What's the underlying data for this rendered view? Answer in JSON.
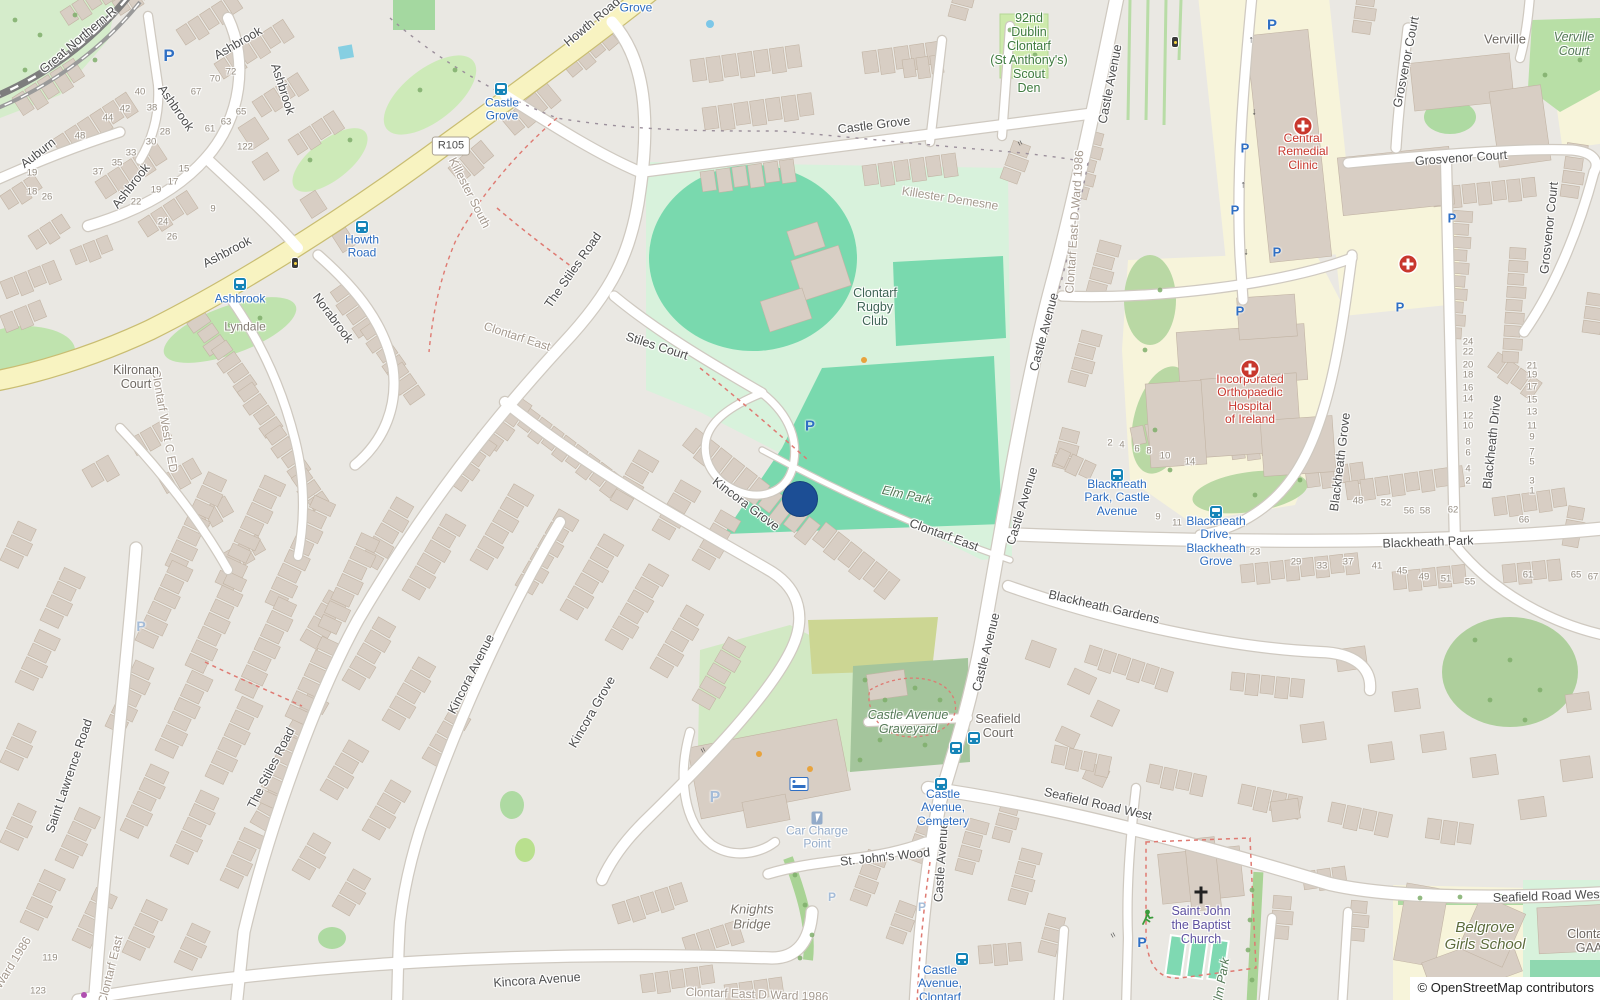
{
  "map": {
    "attribution": "© OpenStreetMap contributors",
    "route_badge": {
      "text": "R105",
      "x": 451,
      "y": 146
    },
    "marker": {
      "x": 800,
      "y": 499,
      "r": 17,
      "color": "#1c4e95"
    },
    "colors": {
      "bus_icon": "#1584b8",
      "parking": "#2f6fc4",
      "parking_faded": "#a5bcd8",
      "marker": "#1c4e95",
      "medical": "#c8372d",
      "church_label": "#5e50a0",
      "runner": "#3b9b3b",
      "bus_label": "#2b6bc0",
      "water": "#86cfe2"
    },
    "street_labels": [
      {
        "t": "Great Northern R",
        "x": 78,
        "y": 40,
        "r": -40
      },
      {
        "t": "Howth Road",
        "x": 592,
        "y": 22,
        "r": -40
      },
      {
        "t": "Ashbrook",
        "x": 238,
        "y": 43,
        "r": -30
      },
      {
        "t": "Ashbrook",
        "x": 283,
        "y": 89,
        "r": 72
      },
      {
        "t": "Ashbrook",
        "x": 176,
        "y": 108,
        "r": 55
      },
      {
        "t": "Ashbrook",
        "x": 131,
        "y": 186,
        "r": -52
      },
      {
        "t": "Ashbrook",
        "x": 227,
        "y": 252,
        "r": -28
      },
      {
        "t": "Auburn",
        "x": 38,
        "y": 153,
        "r": -38
      },
      {
        "t": "Norabrook",
        "x": 333,
        "y": 318,
        "r": 53
      },
      {
        "t": "Kincora Grove",
        "x": 746,
        "y": 504,
        "r": 37
      },
      {
        "t": "Kincora Grove",
        "x": 592,
        "y": 712,
        "r": -60
      },
      {
        "t": "Kincora Avenue",
        "x": 471,
        "y": 674,
        "r": -63
      },
      {
        "t": "Kincora Avenue",
        "x": 537,
        "y": 980,
        "r": -4
      },
      {
        "t": "The Stiles Road",
        "x": 573,
        "y": 270,
        "r": -55
      },
      {
        "t": "The Stiles Road",
        "x": 271,
        "y": 768,
        "r": -63
      },
      {
        "t": "Stiles Court",
        "x": 657,
        "y": 346,
        "r": 18
      },
      {
        "t": "Saint Lawrence Road",
        "x": 69,
        "y": 776,
        "r": -71
      },
      {
        "t": "Castle Grove",
        "x": 874,
        "y": 125,
        "r": -7
      },
      {
        "t": "Castle Avenue",
        "x": 1110,
        "y": 84,
        "r": -79
      },
      {
        "t": "Castle Avenue",
        "x": 1044,
        "y": 332,
        "r": -75
      },
      {
        "t": "Castle Avenue",
        "x": 1022,
        "y": 506,
        "r": -73
      },
      {
        "t": "Castle Avenue",
        "x": 986,
        "y": 652,
        "r": -76
      },
      {
        "t": "Castle Avenue",
        "x": 941,
        "y": 862,
        "r": -86
      },
      {
        "t": "Blackheath Park",
        "x": 1428,
        "y": 542,
        "r": -2
      },
      {
        "t": "Blackheath Gardens",
        "x": 1104,
        "y": 607,
        "r": 13
      },
      {
        "t": "Blackheath Grove",
        "x": 1340,
        "y": 462,
        "r": -83
      },
      {
        "t": "Blackheath Drive",
        "x": 1492,
        "y": 442,
        "r": -84
      },
      {
        "t": "Grosvenor Court",
        "x": 1406,
        "y": 62,
        "r": -79
      },
      {
        "t": "Grosvenor Court",
        "x": 1461,
        "y": 158,
        "r": -4
      },
      {
        "t": "Grosvenor Court",
        "x": 1549,
        "y": 228,
        "r": -84
      },
      {
        "t": "Seafield Road West",
        "x": 1098,
        "y": 804,
        "r": 13
      },
      {
        "t": "Seafield Road West",
        "x": 1548,
        "y": 896,
        "r": -2
      },
      {
        "t": "St. John's Wood",
        "x": 885,
        "y": 857,
        "r": -6
      },
      {
        "t": "Clontarf East",
        "x": 944,
        "y": 535,
        "r": 20
      }
    ],
    "boundary_labels": [
      {
        "t": "Killester South",
        "x": 469,
        "y": 193,
        "r": 63
      },
      {
        "t": "Clontarf West C ED",
        "x": 164,
        "y": 421,
        "r": 80
      },
      {
        "t": "Clontarf East",
        "x": 517,
        "y": 337,
        "r": 18
      },
      {
        "t": "Clontarf East",
        "x": 111,
        "y": 970,
        "r": -76
      },
      {
        "t": "Killester Demesne",
        "x": 950,
        "y": 199,
        "r": 9
      },
      {
        "t": "Clontarf East-D Ward 1986",
        "x": 1075,
        "y": 222,
        "r": -86
      },
      {
        "t": "Clontarf East D Ward 1986",
        "x": 757,
        "y": 995,
        "r": 2
      },
      {
        "t": "D Ward 1986",
        "x": 10,
        "y": 968,
        "r": -58
      }
    ],
    "area_labels": [
      {
        "lines": [
          "Verville",
          "Court"
        ],
        "x": 1574,
        "y": 44
      },
      {
        "lines": [
          "Elm Park"
        ],
        "x": 907,
        "y": 495,
        "r": 12
      },
      {
        "lines": [
          "Castle Avenue",
          "Graveyard"
        ],
        "x": 908,
        "y": 722
      },
      {
        "lines": [
          "Elm Park"
        ],
        "x": 1221,
        "y": 983,
        "r": -80
      },
      {
        "lines": [
          "Belgrove",
          "Girls School"
        ],
        "x": 1485,
        "y": 937,
        "c": "#5c6b3c",
        "s": 15
      },
      {
        "lines": [
          "Knights",
          "Bridge"
        ],
        "x": 752,
        "y": 917,
        "c": "#7a746c",
        "s": 13
      }
    ],
    "poi_labels": [
      {
        "lines": [
          "92nd",
          "Dublin",
          "Clontarf",
          "(St Anthony's)",
          "Scout",
          "Den"
        ],
        "x": 1029,
        "y": 53,
        "c": "#3e7a3e",
        "s": 12.5
      },
      {
        "lines": [
          "Central",
          "Remedial",
          "Clinic"
        ],
        "x": 1303,
        "y": 152,
        "c": "#c8372d"
      },
      {
        "lines": [
          "Incorporated",
          "Orthopaedic",
          "Hospital",
          "of Ireland"
        ],
        "x": 1250,
        "y": 400,
        "c": "#c8372d"
      },
      {
        "lines": [
          "Clontarf",
          "Rugby",
          "Club"
        ],
        "x": 875,
        "y": 307,
        "c": "#3f6456",
        "s": 12.5
      },
      {
        "lines": [
          "Saint John",
          "the Baptist",
          "Church"
        ],
        "x": 1201,
        "y": 925,
        "c": "#5e50a0",
        "s": 12.5
      },
      {
        "lines": [
          "Verville"
        ],
        "x": 1505,
        "y": 40,
        "c": "#6e6862",
        "s": 13
      },
      {
        "lines": [
          "Lyndale"
        ],
        "x": 245,
        "y": 327,
        "c": "#857d75"
      },
      {
        "lines": [
          "Kilronan",
          "Court"
        ],
        "x": 136,
        "y": 377,
        "c": "#6e6862",
        "s": 12.5
      },
      {
        "lines": [
          "Seafield",
          "Court"
        ],
        "x": 998,
        "y": 726,
        "c": "#6e6862",
        "s": 12.5
      },
      {
        "lines": [
          "Clontarf",
          "GAA"
        ],
        "x": 1589,
        "y": 941,
        "c": "#6e6862",
        "s": 12.5
      },
      {
        "lines": [
          "Car Charge",
          "Point"
        ],
        "x": 817,
        "y": 838,
        "c": "#93abc9"
      }
    ],
    "bus_stops": [
      {
        "lines": [
          "Grove"
        ],
        "x": 636,
        "y": 8,
        "icons": []
      },
      {
        "lines": [
          "Castle",
          "Grove"
        ],
        "x": 502,
        "y": 110,
        "icons": [
          [
            501,
            89
          ]
        ]
      },
      {
        "lines": [
          "Howth",
          "Road"
        ],
        "x": 362,
        "y": 247,
        "icons": [
          [
            362,
            227
          ]
        ]
      },
      {
        "lines": [
          "Ashbrook"
        ],
        "x": 240,
        "y": 299,
        "icons": [
          [
            240,
            284
          ]
        ]
      },
      {
        "lines": [
          "Blackheath",
          "Park, Castle",
          "Avenue"
        ],
        "x": 1117,
        "y": 498,
        "icons": [
          [
            1117,
            475
          ]
        ]
      },
      {
        "lines": [
          "Blackheath",
          "Drive,",
          "Blackheath",
          "Grove"
        ],
        "x": 1216,
        "y": 542,
        "icons": [
          [
            1216,
            512
          ]
        ]
      },
      {
        "lines": [
          "Castle",
          "Avenue,",
          "Cemetery"
        ],
        "x": 943,
        "y": 808,
        "icons": [
          [
            956,
            748
          ],
          [
            974,
            738
          ],
          [
            941,
            784
          ]
        ]
      },
      {
        "lines": [
          "Castle",
          "Avenue,",
          "Clontarf"
        ],
        "x": 940,
        "y": 984,
        "icons": [
          [
            962,
            959
          ]
        ]
      }
    ],
    "parking": {
      "glyph": "P",
      "items": [
        [
          169,
          56,
          17
        ],
        [
          1272,
          25,
          15
        ],
        [
          1245,
          148,
          13
        ],
        [
          1235,
          210,
          13
        ],
        [
          1277,
          252,
          13
        ],
        [
          810,
          426,
          15
        ],
        [
          1240,
          311,
          13
        ],
        [
          1400,
          307,
          13
        ],
        [
          1452,
          218,
          13
        ],
        [
          1142,
          942,
          14
        ]
      ],
      "faded": [
        [
          141,
          626,
          14
        ],
        [
          715,
          798,
          16
        ],
        [
          832,
          897,
          12
        ],
        [
          922,
          907,
          12
        ]
      ]
    },
    "house_numbers": [
      [
        40,
        140,
        93
      ],
      [
        38,
        152,
        109
      ],
      [
        42,
        125,
        110
      ],
      [
        44,
        108,
        119
      ],
      [
        48,
        80,
        137
      ],
      [
        28,
        165,
        133
      ],
      [
        30,
        151,
        143
      ],
      [
        33,
        131,
        154
      ],
      [
        35,
        117,
        164
      ],
      [
        37,
        98,
        173
      ],
      [
        19,
        32,
        174
      ],
      [
        18,
        32,
        193
      ],
      [
        26,
        47,
        198
      ],
      [
        22,
        136,
        203
      ],
      [
        24,
        163,
        223
      ],
      [
        26,
        172,
        238
      ],
      [
        67,
        196,
        93
      ],
      [
        70,
        215,
        80
      ],
      [
        72,
        231,
        73
      ],
      [
        61,
        210,
        130
      ],
      [
        63,
        226,
        123
      ],
      [
        65,
        241,
        113
      ],
      [
        122,
        245,
        148
      ],
      [
        15,
        184,
        170
      ],
      [
        17,
        173,
        183
      ],
      [
        19,
        156,
        191
      ],
      [
        9,
        213,
        210
      ],
      [
        24,
        1468,
        343
      ],
      [
        22,
        1468,
        353
      ],
      [
        20,
        1468,
        366
      ],
      [
        18,
        1468,
        376
      ],
      [
        16,
        1468,
        389
      ],
      [
        14,
        1468,
        400
      ],
      [
        12,
        1468,
        417
      ],
      [
        10,
        1468,
        427
      ],
      [
        8,
        1468,
        443
      ],
      [
        6,
        1468,
        454
      ],
      [
        4,
        1468,
        470
      ],
      [
        2,
        1468,
        482
      ],
      [
        21,
        1532,
        367
      ],
      [
        19,
        1532,
        376
      ],
      [
        17,
        1532,
        388
      ],
      [
        15,
        1532,
        401
      ],
      [
        13,
        1532,
        413
      ],
      [
        11,
        1532,
        427
      ],
      [
        9,
        1532,
        438
      ],
      [
        7,
        1532,
        453
      ],
      [
        5,
        1532,
        463
      ],
      [
        3,
        1532,
        482
      ],
      [
        1,
        1532,
        492
      ],
      [
        2,
        1110,
        444
      ],
      [
        4,
        1122,
        446
      ],
      [
        6,
        1137,
        450
      ],
      [
        8,
        1149,
        452
      ],
      [
        10,
        1165,
        457
      ],
      [
        14,
        1190,
        463
      ],
      [
        9,
        1158,
        518
      ],
      [
        11,
        1177,
        524
      ],
      [
        48,
        1358,
        502
      ],
      [
        52,
        1386,
        504
      ],
      [
        56,
        1409,
        512
      ],
      [
        58,
        1425,
        512
      ],
      [
        62,
        1453,
        511
      ],
      [
        66,
        1524,
        521
      ],
      [
        23,
        1255,
        553
      ],
      [
        29,
        1296,
        563
      ],
      [
        33,
        1322,
        567
      ],
      [
        37,
        1348,
        563
      ],
      [
        41,
        1377,
        567
      ],
      [
        45,
        1402,
        572
      ],
      [
        49,
        1424,
        578
      ],
      [
        51,
        1446,
        580
      ],
      [
        55,
        1470,
        583
      ],
      [
        61,
        1528,
        576
      ],
      [
        65,
        1576,
        576
      ],
      [
        67,
        1593,
        578
      ],
      [
        119,
        50,
        959
      ],
      [
        123,
        38,
        992
      ]
    ],
    "dots": [
      {
        "x": 864,
        "y": 360,
        "r": 3,
        "c": "#e8a33d"
      },
      {
        "x": 759,
        "y": 754,
        "r": 3,
        "c": "#e8a33d"
      },
      {
        "x": 810,
        "y": 769,
        "r": 3,
        "c": "#e8a33d"
      },
      {
        "x": 710,
        "y": 24,
        "r": 4,
        "c": "#7cc7e8"
      },
      {
        "x": 84,
        "y": 995,
        "r": 3,
        "c": "#b04fb0"
      }
    ],
    "medical_crosses": [
      [
        1303,
        126
      ],
      [
        1250,
        369
      ],
      [
        1408,
        264
      ]
    ],
    "church_cross": [
      1201,
      895
    ],
    "runner": [
      1147,
      920
    ],
    "bed_icon": [
      799,
      784
    ],
    "charge_icon": [
      817,
      818
    ],
    "signals": [
      [
        295,
        263
      ],
      [
        1175,
        42
      ]
    ],
    "gates": [
      [
        703,
        750
      ],
      [
        1113,
        935
      ],
      [
        1020,
        143
      ]
    ],
    "oneway_arrows": [
      [
        1251,
        40,
        "↑"
      ],
      [
        1254,
        112,
        "↓"
      ],
      [
        1243,
        185,
        "↑"
      ],
      [
        1246,
        252,
        "↓"
      ]
    ],
    "water_rect": {
      "x": 346,
      "y": 52,
      "w": 14,
      "h": 13
    }
  }
}
